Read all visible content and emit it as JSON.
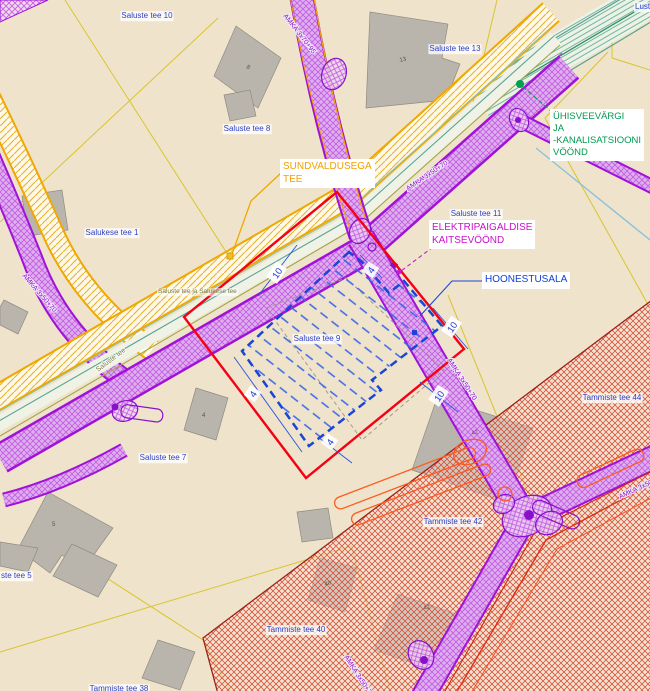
{
  "callouts": {
    "sundvaldusega": [
      "SUNDVALDUSEGA",
      "TEE"
    ],
    "elektripaigaldise": [
      "ELEKTRIPAIGALDISE",
      "KAITSEVÖÖND"
    ],
    "hoonestusala": [
      "HOONESTUSALA"
    ],
    "uhisveevark": [
      "ÜHISVEEVÄRGI",
      "JA",
      "-KANALISATSIOONI",
      "VÖÖND"
    ]
  },
  "parcels": {
    "saluste10": "Saluste tee 10",
    "saluste13": "Saluste tee 13",
    "saluste8": "Saluste tee 8",
    "salukese1": "Salukese tee 1",
    "saluste11": "Saluste tee 11",
    "saluste9": "Saluste tee 9",
    "saluste7": "Saluste tee 7",
    "saluste5": "ste tee 5",
    "tammiste44": "Tammiste tee 44",
    "tammiste42": "Tammiste tee 42",
    "tammiste40": "Tammiste tee 40",
    "tammiste38": "Tammiste tee 38",
    "lusti": "Lust",
    "road_combined": "Saluste tee ja Salukese tee"
  },
  "roads": {
    "amka_70_95": "AMKA 3x70+95",
    "amka_50_70": "AMKA 3x50+70",
    "saluste_tee": "Saluste tee"
  },
  "dimensions": {
    "ten": "10",
    "four": "4"
  },
  "buildings": {
    "b8": "8",
    "b13": "13",
    "b4": "4",
    "b5": "5",
    "b40": "40",
    "b42": "42"
  },
  "colors": {
    "background": "#efe4cb",
    "planning_boundary_red": "#f50014",
    "hoonestusala_blue": "#1a46d8",
    "electrical_purple": "#9912d0",
    "road_sundvaldus_yellow": "#f0a800",
    "water_sewer_green": "#009a50",
    "restriction_zone_red": "#d4402c",
    "cadastral_yellow": "#d8c42e",
    "building_gray": "#bab5ac",
    "parcel_label_blue": "#2b3fc4"
  }
}
